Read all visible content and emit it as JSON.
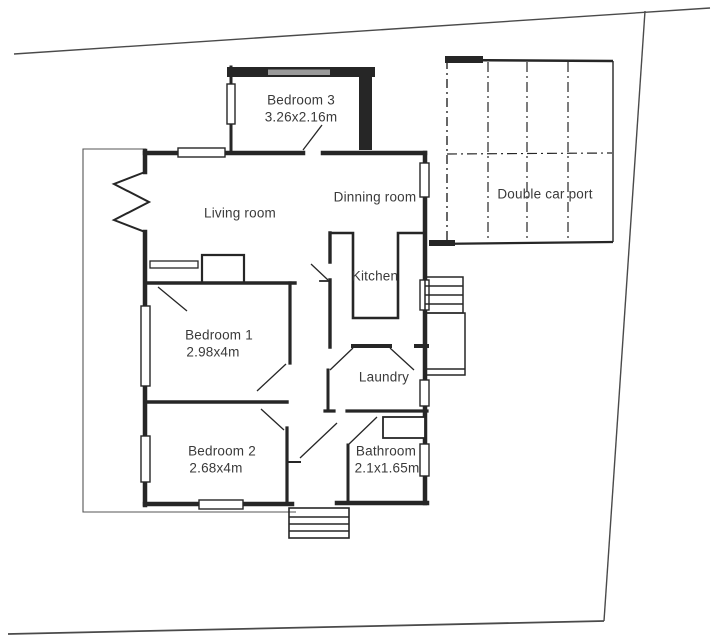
{
  "page": {
    "title": "House floor plan",
    "background": "#ffffff",
    "ink_color": "#262626",
    "label_color": "#3a3a3a",
    "boundary_color": "#4a4a4a",
    "window_gray": "#9a9a9a"
  },
  "rooms": {
    "bedroom3": {
      "label": "Bedroom 3",
      "dims": "3.26x2.16m"
    },
    "living": {
      "label": "Living room"
    },
    "dinning": {
      "label": "Dinning room"
    },
    "carport": {
      "label": "Double car port"
    },
    "kitchen": {
      "label": "Kitchen"
    },
    "bedroom1": {
      "label": "Bedroom 1",
      "dims": "2.98x4m"
    },
    "laundry": {
      "label": "Laundry"
    },
    "bedroom2": {
      "label": "Bedroom 2",
      "dims": "2.68x4m"
    },
    "bathroom": {
      "label": "Bathroom",
      "dims": "2.1x1.65m"
    }
  }
}
